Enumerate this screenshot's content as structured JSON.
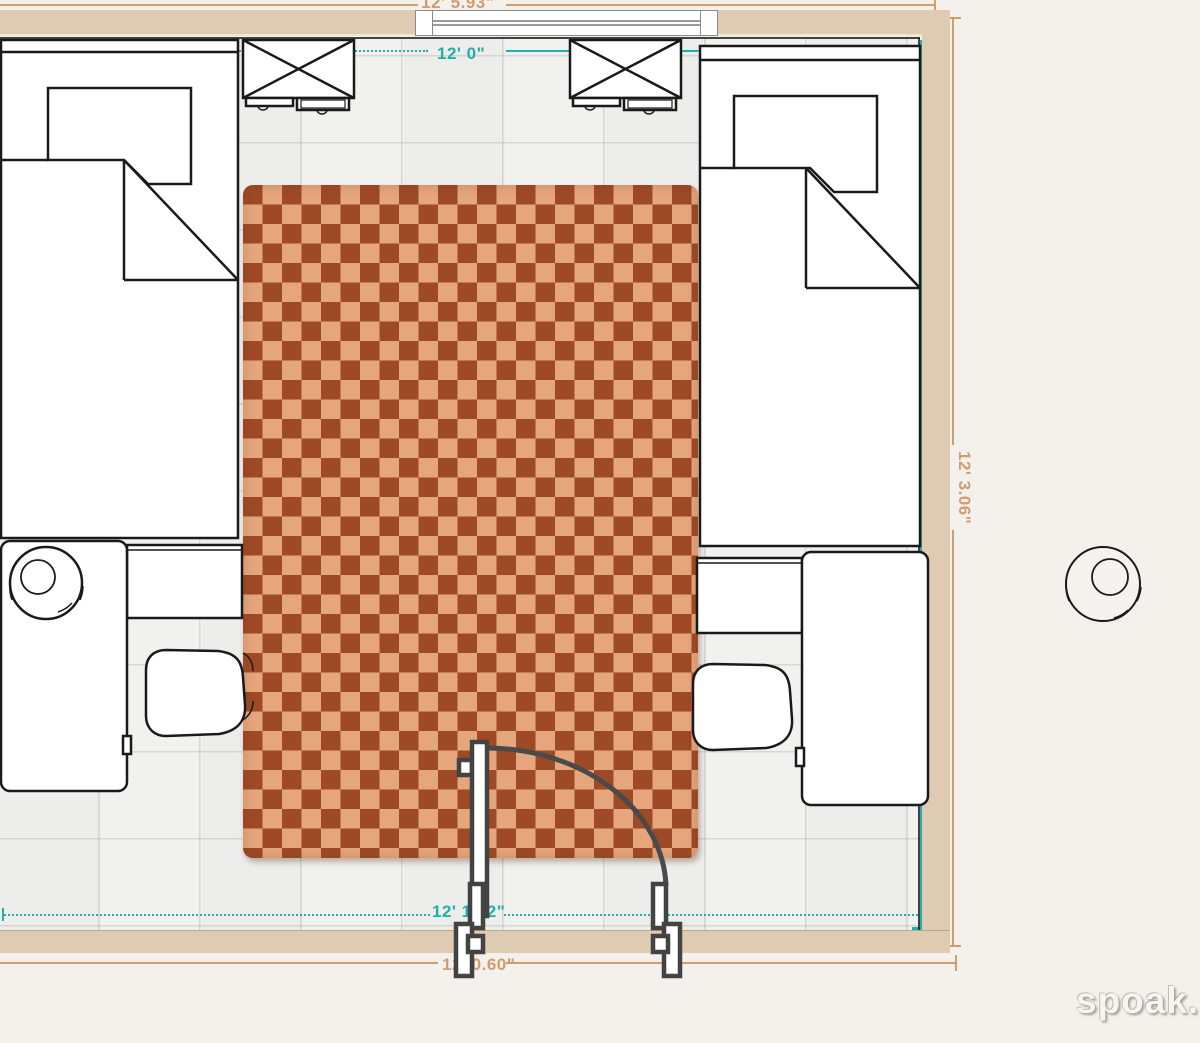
{
  "plan": {
    "watermark": "spoak.",
    "room": {
      "dimensions": {
        "outer_top": "12' 5.93\"",
        "inner_top": "12' 0\"",
        "outer_right": "12' 3.06\"",
        "inner_bottom": "12' 1.52\"",
        "outer_bottom": "12' 0.60\""
      },
      "colors": {
        "dimension_teal": "#1db1a8",
        "dimension_tan": "#cf9c6f",
        "wall": "#dfcbb1",
        "floor": "#f1f1ef",
        "background": "#f4f1ec",
        "rug_dark": "#9e4a27",
        "rug_light": "#e5a67d",
        "furniture_outline": "#1a1a1a",
        "door_outline": "#434343"
      },
      "furniture": [
        {
          "name": "bed-left"
        },
        {
          "name": "bed-right"
        },
        {
          "name": "dresser-left"
        },
        {
          "name": "dresser-right"
        },
        {
          "name": "desk-left"
        },
        {
          "name": "desk-right"
        },
        {
          "name": "chair-left"
        },
        {
          "name": "chair-right"
        },
        {
          "name": "table-lamp"
        },
        {
          "name": "rug"
        },
        {
          "name": "window"
        },
        {
          "name": "door"
        },
        {
          "name": "planter-outside"
        }
      ]
    }
  }
}
